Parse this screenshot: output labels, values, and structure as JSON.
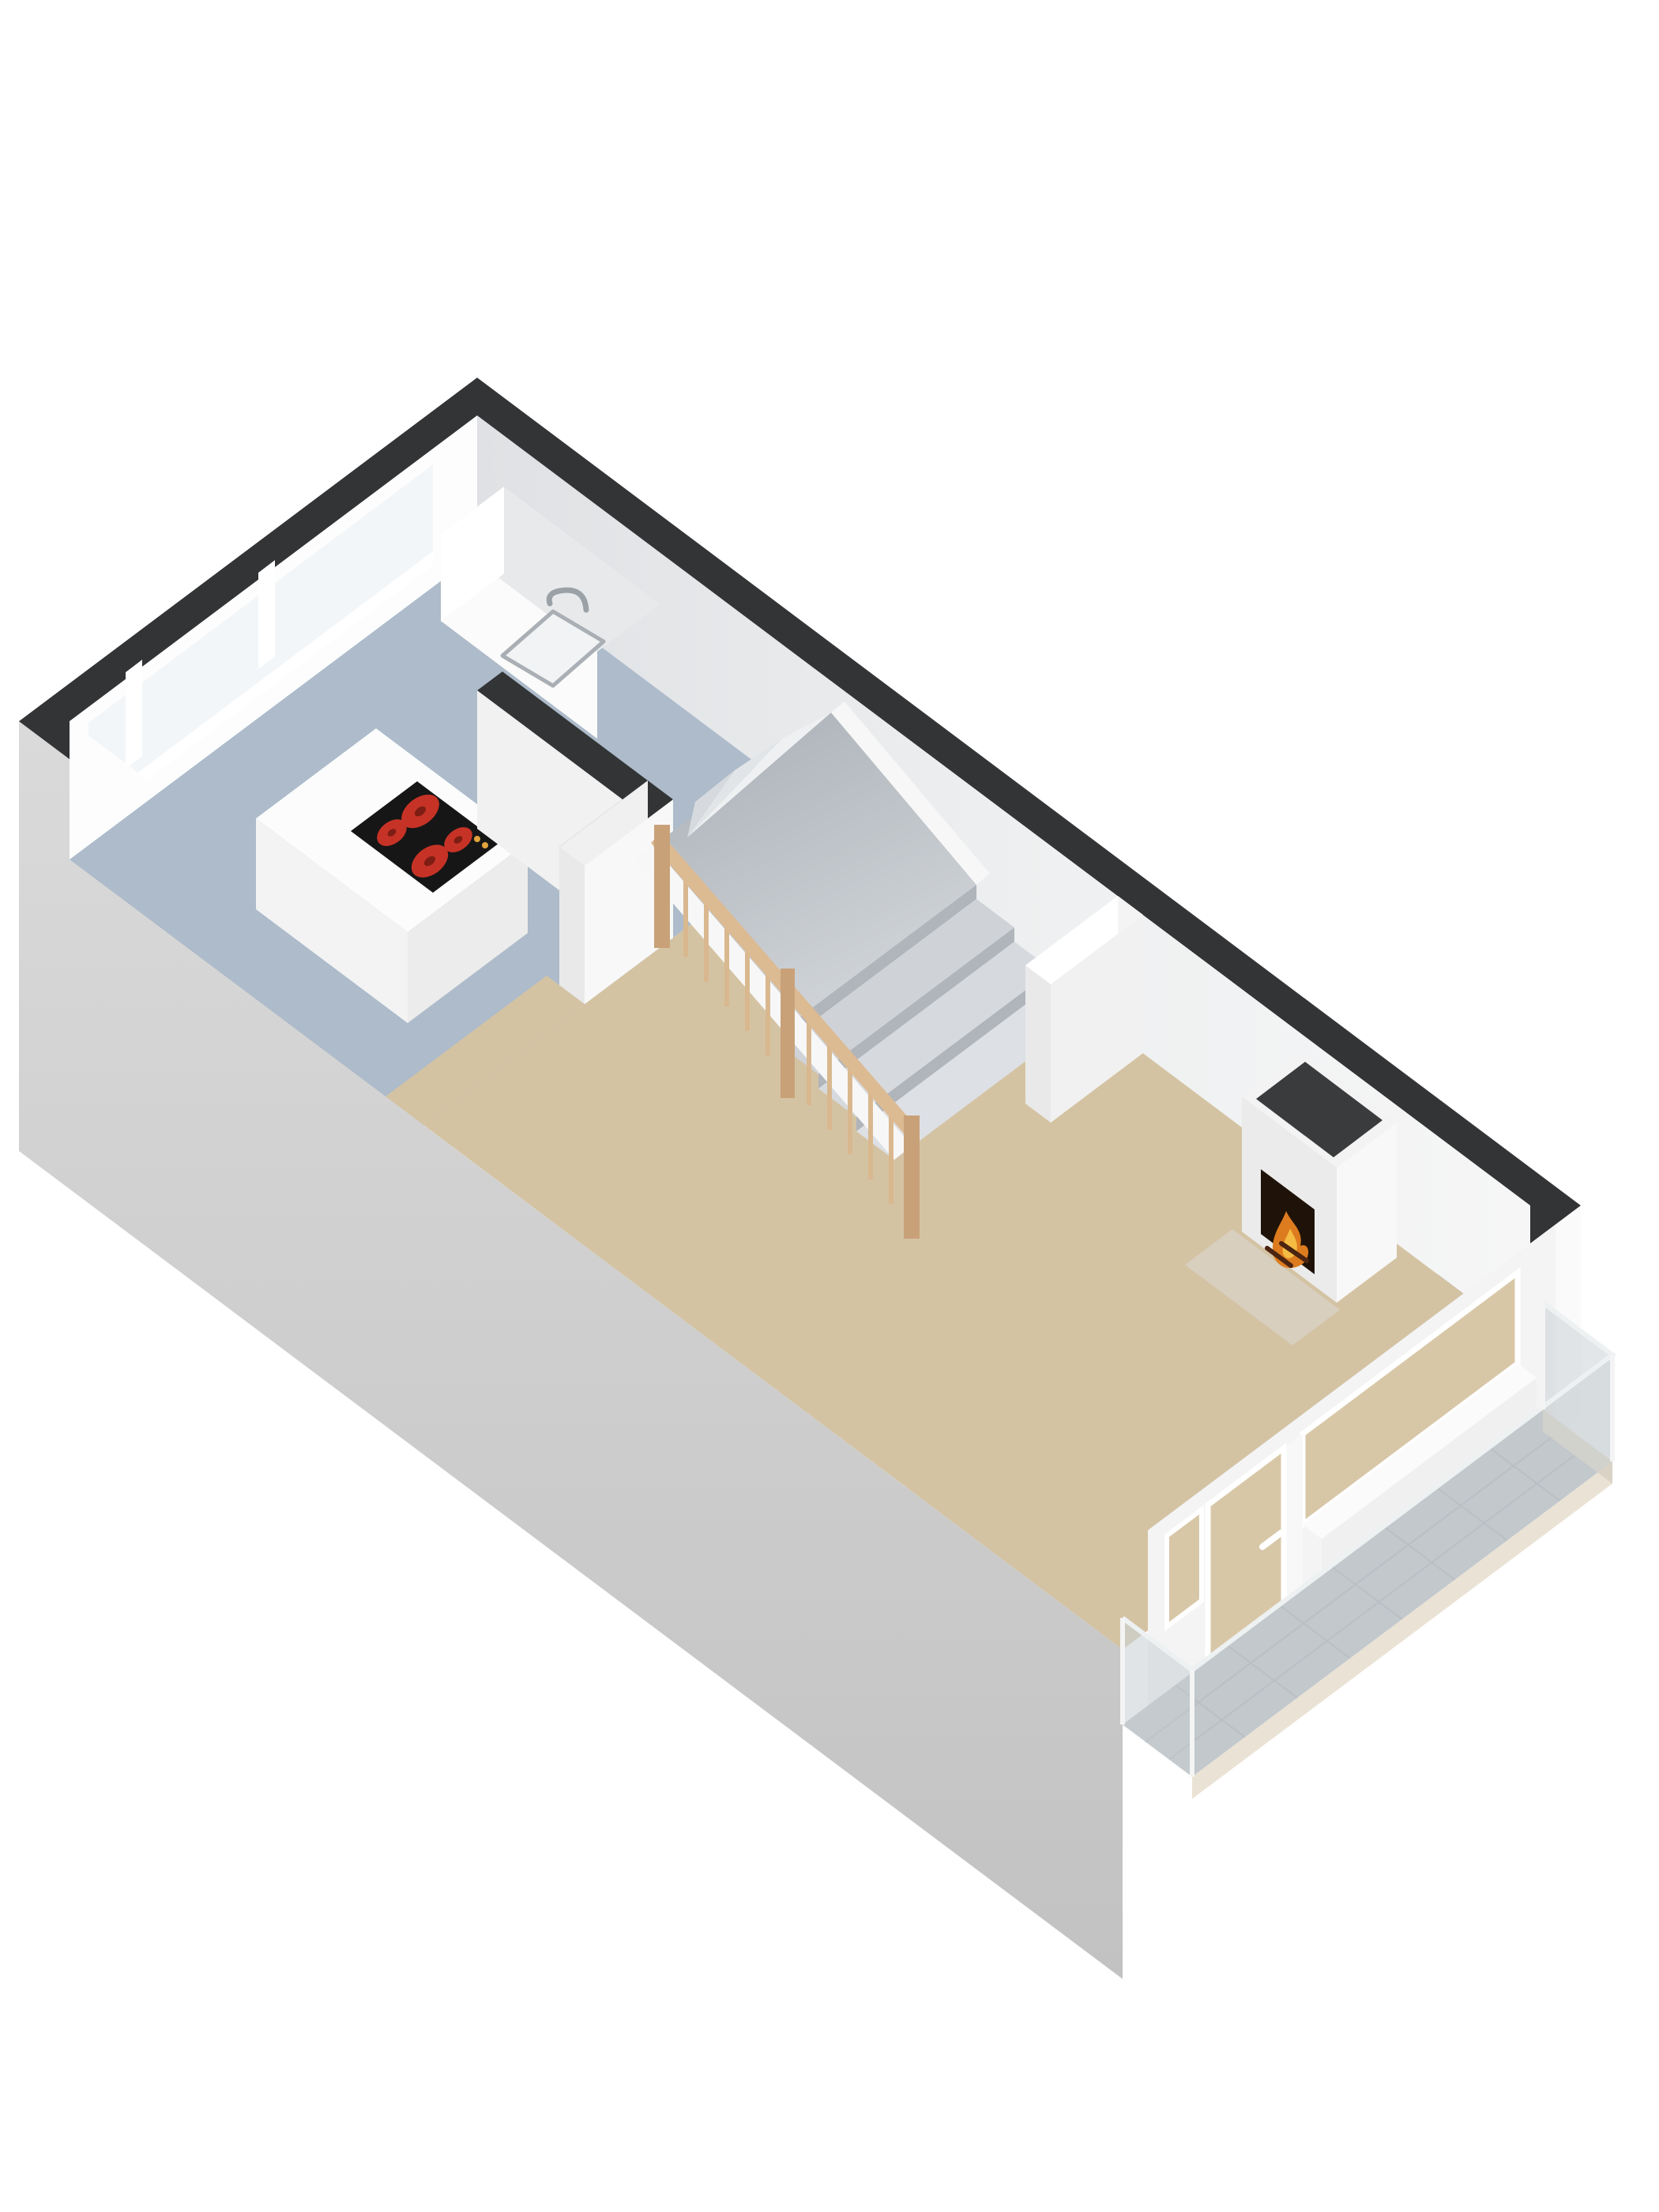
{
  "scene": {
    "type": "isometric-3d-floorplan",
    "floor_shown": "ground-floor",
    "rooms_visible": 3,
    "objects": [
      "exterior-walls",
      "wall-caps",
      "kitchen",
      "kitchen-window-band",
      "kitchen-counter",
      "sink",
      "faucet",
      "kitchen-island",
      "induction-cooktop",
      "cooktop-burners",
      "interior-partitions",
      "winder-staircase",
      "wood-balustrade",
      "living-room",
      "chimney",
      "fireplace-fire",
      "hearth",
      "glazed-facade",
      "front-door",
      "door-handle",
      "facade-window",
      "balcony",
      "balcony-tiles",
      "glass-railing"
    ]
  },
  "counts": {
    "cooktop_burners": 4,
    "balustrade_spindles": 13,
    "facade_openings": 3,
    "kitchen_window_mullions": 2
  },
  "colors": {
    "background": "#ffffff",
    "wall_cap": "#333436",
    "exterior_top": "#dadada",
    "exterior_bottom": "#c2c2c2",
    "interior_white": "#fdfdfd",
    "interior_bright": "#ffffff",
    "interior_shade": "#f1f1f1",
    "interior_dark": "#e8e8e8",
    "ne_wall_near": "#dfe1e4",
    "ne_wall_far": "#f6f6f6",
    "kitchen_floor": "#adbbca",
    "living_floor": "#d4c3a3",
    "window_glass": "#f3f6f8",
    "frame_white": "#ffffff",
    "counter_top": "#e7e9eb",
    "counter_front": "#fbfbfb",
    "sink_fill": "#f1f3f4",
    "sink_rim": "#a9afb4",
    "faucet_chrome": "#9aa1a7",
    "island_top": "#fcfcfc",
    "island_sw": "#f3f3f3",
    "island_se": "#ececec",
    "cooktop_black": "#161616",
    "burner_red": "#c63326",
    "burner_core": "#7e1d14",
    "control_orange": "#e2a43c",
    "partition_nw": "#f0f0f0",
    "partition_se": "#f8f8f8",
    "partition_end": "#e9e9e9",
    "low_wall_cap": "#f4f4f4",
    "flight_top": "#a9afb6",
    "flight_bottom": "#d0d4d8",
    "fan_1": "#eef0f2",
    "fan_2": "#e2e5e8",
    "fan_3": "#d6dade",
    "step_face": "#b0b5bb",
    "step_tread_a": "#cfd3d7",
    "step_tread_b": "#d6dade",
    "step_tread_c": "#dde0e4",
    "stringer_white": "#f7f7f7",
    "wood_rail": "#dcba92",
    "wood_spindle": "#d9b88f",
    "wood_post": "#c9a179",
    "chimney_front": "#ebebeb",
    "chimney_side": "#f8f8f8",
    "chimney_rim": "#f3f3f3",
    "chimney_shaft": "#3a3b3d",
    "fire_bg": "#1f1309",
    "fire_orange": "#dd7b1f",
    "fire_yellow": "#f4bc42",
    "log_brown": "#4a2410",
    "hearth": "#d9d3c8",
    "facade_frame": "#f4f4f4",
    "facade_glass": "#d8c7a7",
    "spandrel_top": "#fbfbfb",
    "spandrel_front": "#f0f0f0",
    "threshold": "#f6f6f6",
    "balcony_tile": "#b9bec3",
    "tile_line": "#a8adb2",
    "balcony_glass": "#ccd2d6",
    "glass_top_edge": "#eef1f2",
    "post_white": "#f4f4f4",
    "slab_cream": "#eae2d4",
    "slab_gray": "#d9d2c5",
    "end_face_white": "#fafafa"
  }
}
